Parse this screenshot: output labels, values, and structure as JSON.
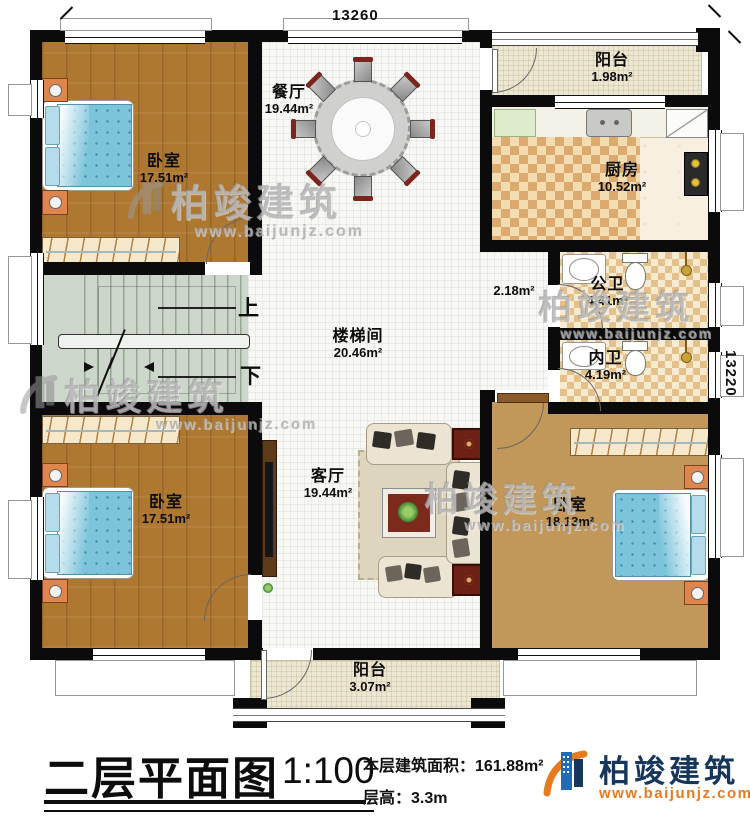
{
  "dimensions": {
    "width_label": "13260",
    "height_label": "13220"
  },
  "rooms": [
    {
      "id": "bedroom-top-left",
      "name": "卧室",
      "area": "17.51m²"
    },
    {
      "id": "dining",
      "name": "餐厅",
      "area": "19.44m²"
    },
    {
      "id": "balcony-top",
      "name": "阳台",
      "area": "1.98m²"
    },
    {
      "id": "kitchen",
      "name": "厨房",
      "area": "10.52m²"
    },
    {
      "id": "public-bath",
      "name": "公卫",
      "area": "4.41m²"
    },
    {
      "id": "private-bath",
      "name": "内卫",
      "area": "4.19m²"
    },
    {
      "id": "corridor",
      "name": "",
      "area": "2.18m²"
    },
    {
      "id": "stairwell",
      "name": "楼梯间",
      "area": "20.46m²"
    },
    {
      "id": "living",
      "name": "客厅",
      "area": "19.44m²"
    },
    {
      "id": "bedroom-bottom-left",
      "name": "卧室",
      "area": "17.51m²"
    },
    {
      "id": "bedroom-bottom-right",
      "name": "卧室",
      "area": "18.13m²"
    },
    {
      "id": "balcony-bottom",
      "name": "阳台",
      "area": "3.07m²"
    }
  ],
  "stairs": {
    "up_label": "上",
    "down_label": "下"
  },
  "title_block": {
    "plan_title": "二层平面图",
    "scale": "1:100",
    "area_label": "本层建筑面积：",
    "area_value": "161.88m²",
    "height_label": "层高：",
    "height_value": "3.3m"
  },
  "brand": {
    "company_name": "柏竣建筑",
    "website": "www.baijunjz.com"
  },
  "watermark": {
    "text": "柏竣建筑",
    "website": "www.baijunjz.com"
  },
  "colors": {
    "wall": "#0b0b0b",
    "wood_floor": "#ae7831",
    "stair_floor": "#ccd6ca",
    "bed_blue": "#7cc4da",
    "brand_blue": "#17365c",
    "brand_orange": "#e87a1e"
  }
}
